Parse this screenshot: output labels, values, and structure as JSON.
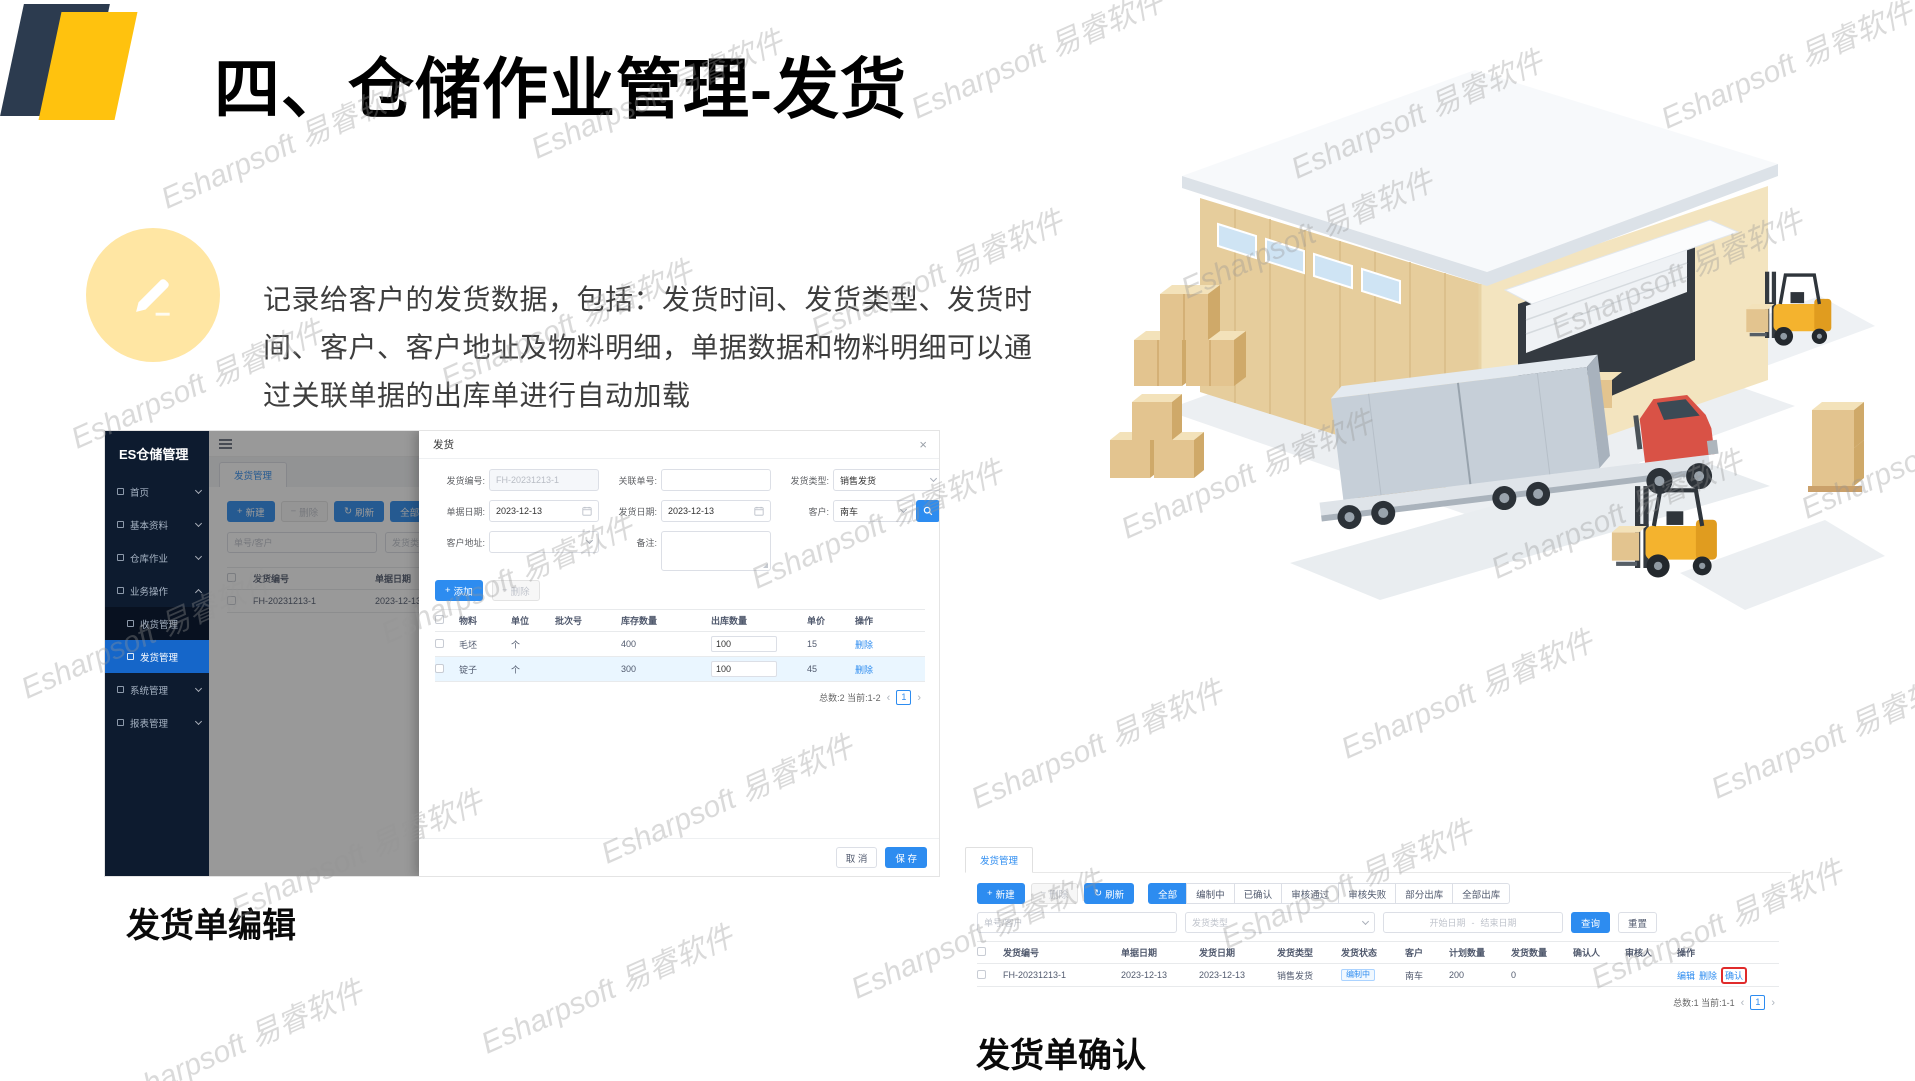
{
  "slide": {
    "title": "四、仓储作业管理-发货",
    "description_lines": [
      "记录给客户的发货数据，包括：发货时间、发货类型、发货时",
      "间、客户、客户地址及物料明细，单据数据和物料明细可以通",
      "过关联单据的出库单进行自动加载"
    ],
    "caption_left": "发货单编辑",
    "caption_right": "发货单确认",
    "watermark": "Esharpsoft 易睿软件"
  },
  "colors": {
    "accent_blue": "#2d8cf0",
    "sidebar_navy": "#0d1b2f",
    "selected_blue": "#1566c9",
    "brand_yellow": "#ffc20e",
    "shape_navy": "#2c3b4f",
    "icon_circle_yellow": "#ffe6a3",
    "annotation_red": "#e02b2b"
  },
  "edit_window": {
    "sidebar": {
      "title": "ES仓储管理",
      "items": [
        {
          "label": "首页"
        },
        {
          "label": "基本资料"
        },
        {
          "label": "仓库作业"
        },
        {
          "label": "业务操作"
        },
        {
          "label": "收货管理"
        },
        {
          "label": "发货管理"
        },
        {
          "label": "系统管理"
        },
        {
          "label": "报表管理"
        }
      ]
    },
    "tab": "发货管理",
    "background_list": {
      "new_button": "新建",
      "delete_button": "删除",
      "refresh_button": "刷新",
      "filter_all": "全部",
      "filter_drafting": "编制中",
      "search_placeholder": "单号/客户",
      "type_placeholder": "发货类型",
      "columns": [
        "发货编号",
        "单据日期"
      ],
      "row": [
        "FH-20231213-1",
        "2023-12-13"
      ]
    },
    "dialog": {
      "title": "发货",
      "fields": {
        "code_label": "发货编号:",
        "code_value": "FH-20231213-1",
        "related_label": "关联单号:",
        "related_value": "",
        "type_label": "发货类型:",
        "type_value": "销售发货",
        "doc_date_label": "单据日期:",
        "doc_date_value": "2023-12-13",
        "ship_date_label": "发货日期:",
        "ship_date_value": "2023-12-13",
        "customer_label": "客户:",
        "customer_value": "南车",
        "address_label": "客户地址:",
        "remark_label": "备注:"
      },
      "add_button": "添加",
      "remove_button": "删除",
      "table": {
        "columns": [
          "物料",
          "单位",
          "批次号",
          "库存数量",
          "出库数量",
          "单价",
          "操作"
        ],
        "rows": [
          {
            "material": "毛坯",
            "unit": "个",
            "batch": "",
            "stock": "400",
            "out_qty": "100",
            "price": "15",
            "op": "删除"
          },
          {
            "material": "锭子",
            "unit": "个",
            "batch": "",
            "stock": "300",
            "out_qty": "100",
            "price": "45",
            "op": "删除"
          }
        ]
      },
      "pagination": "总数:2 当前:1-2",
      "page": "1",
      "cancel_button": "取 消",
      "save_button": "保 存"
    }
  },
  "confirm_window": {
    "tab": "发货管理",
    "toolbar": {
      "new_button": "新建",
      "delete_button": "删除",
      "refresh_button": "刷新"
    },
    "status_filters": [
      "全部",
      "编制中",
      "已确认",
      "审核通过",
      "审核失败",
      "部分出库",
      "全部出库"
    ],
    "filters": {
      "search_placeholder": "单号/客户",
      "type_placeholder": "发货类型",
      "start_date_placeholder": "开始日期",
      "range_separator": "-",
      "end_date_placeholder": "结束日期",
      "search_button": "查询",
      "reset_button": "重置"
    },
    "table": {
      "columns": [
        "发货编号",
        "单据日期",
        "发货日期",
        "发货类型",
        "发货状态",
        "客户",
        "计划数量",
        "发货数量",
        "确认人",
        "审核人",
        "操作"
      ],
      "row": {
        "code": "FH-20231213-1",
        "doc_date": "2023-12-13",
        "ship_date": "2023-12-13",
        "type": "销售发货",
        "status": "编制中",
        "customer": "南车",
        "plan_qty": "200",
        "ship_qty": "0",
        "confirmer": "",
        "auditor": "",
        "ops": [
          "编辑",
          "删除",
          "确认"
        ]
      }
    },
    "pagination": "总数:1 当前:1-1",
    "page": "1"
  }
}
